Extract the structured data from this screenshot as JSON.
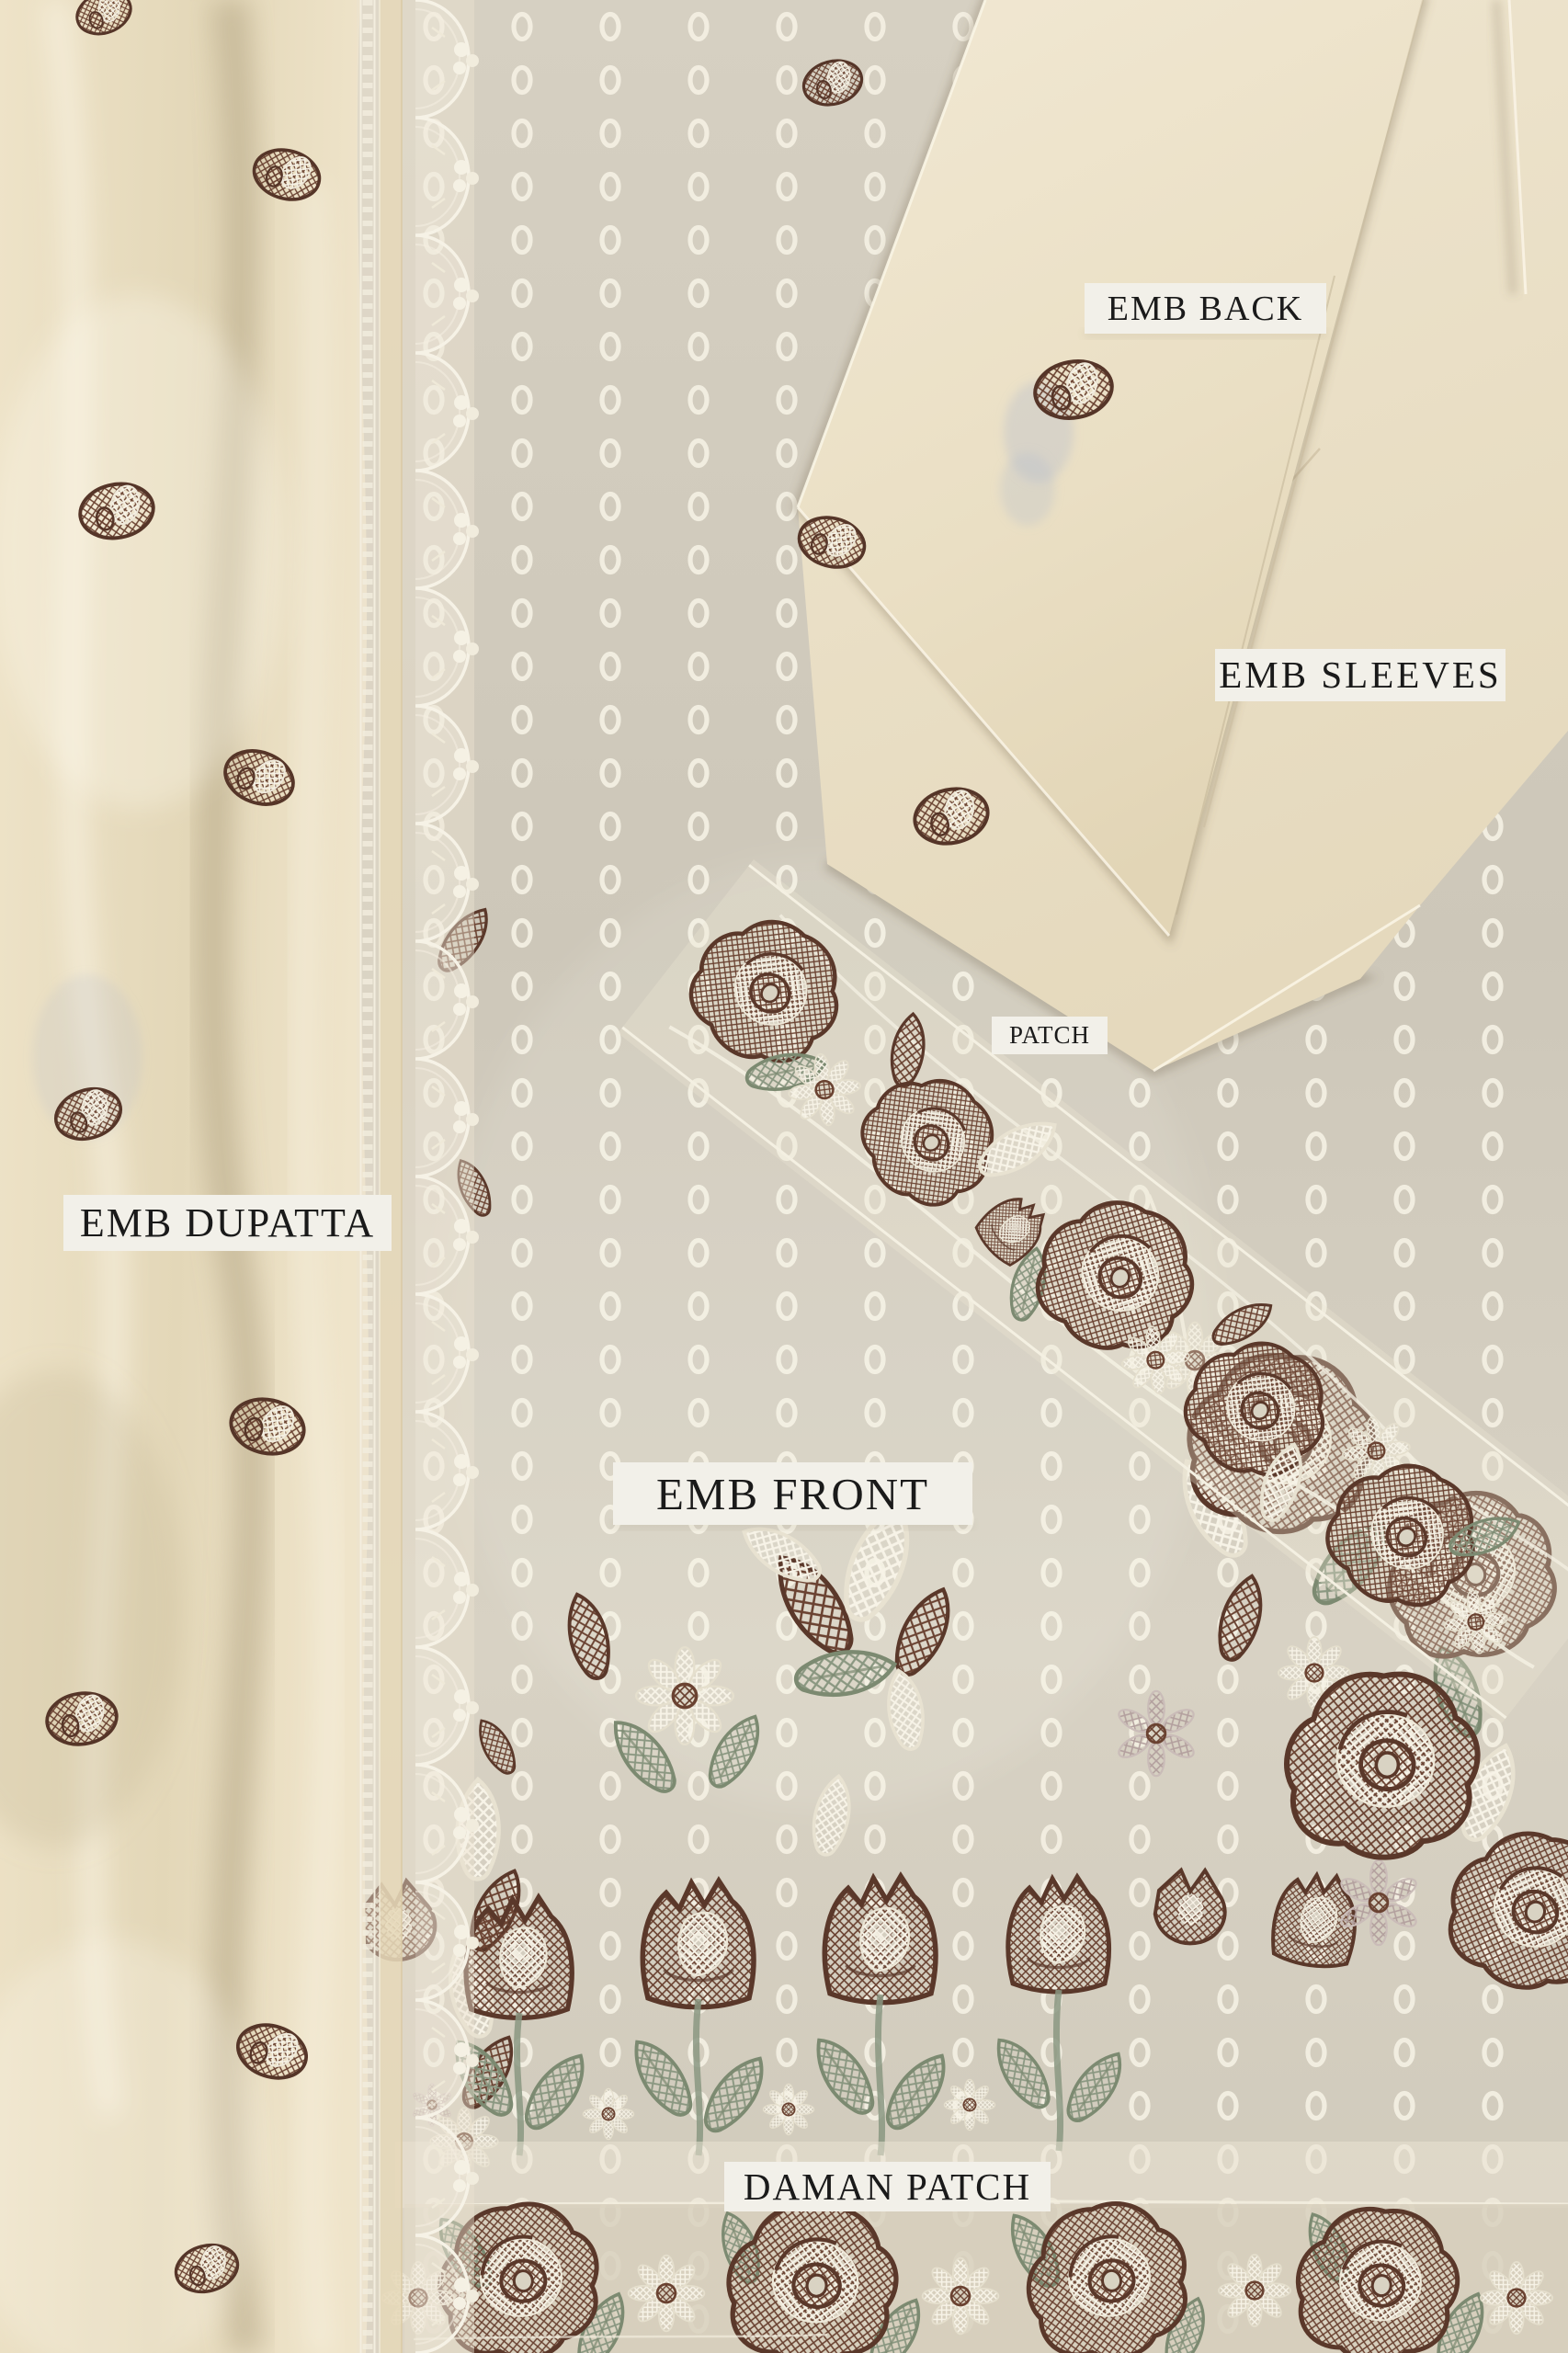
{
  "labels": {
    "back": "EMB BACK",
    "sleeves": "EMB SLEEVES",
    "patch": "PATCH",
    "dupatta": "EMB DUPATTA",
    "front": "EMB FRONT",
    "daman": "DAMAN PATCH"
  },
  "palette": {
    "dupatta_cream": "#e9dfc6",
    "front_fabric_grey_cream": "#d1cbbd",
    "folded_pieces_cream": "#ede3cc",
    "embroidery_brown": "#5d3a2b",
    "leaf_green": "#8b9880",
    "mauve_accent": "#b3a09e",
    "lace_white": "#f4f0e3",
    "eyelet_ring_white": "#f3efe2",
    "label_background": "#f2f0e9",
    "label_text": "#1a1a1a"
  }
}
